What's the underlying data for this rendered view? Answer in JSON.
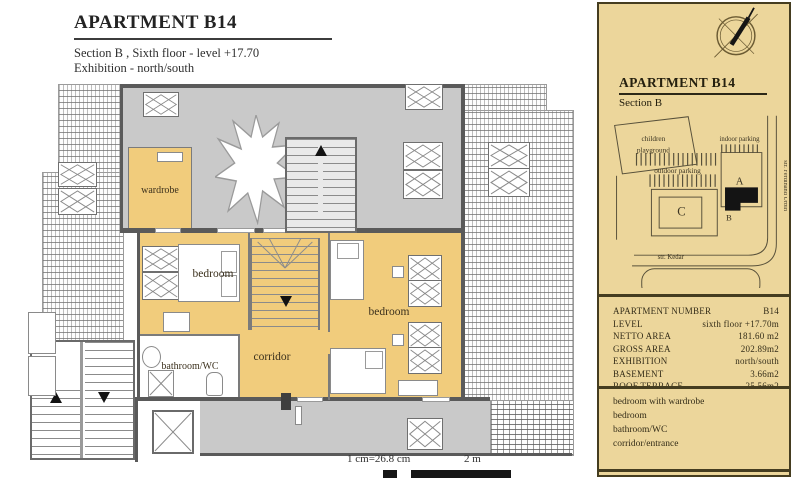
{
  "title_block": {
    "title": "APARTMENT B14",
    "line1": "Section B ,  Sixth floor - level +17.70",
    "line2": "Exhibition - north/south"
  },
  "plan": {
    "labels": {
      "wardrobe": "wardrobe",
      "bedroom_left": "bedroom",
      "bedroom_right": "bedroom",
      "corridor": "corridor",
      "bathroom": "bathroom/WC"
    },
    "scale": {
      "ratio": "1 cm=26.8 cm",
      "bar_label": "2 m"
    }
  },
  "panel": {
    "title": "APARTMENT B14",
    "subtitle": "Section B",
    "site": {
      "playground_line1": "children",
      "playground_line2": "playground",
      "indoor_parking": "indoor parking",
      "outdoor_parking": "outdoor parking",
      "building_a": "A",
      "building_b": "B",
      "building_c": "C",
      "street_right": "str. Ferdinand Urbih",
      "street_bottom": "str. Kedar"
    },
    "info_rows": [
      {
        "label": "APARTMENT NUMBER",
        "value": "B14"
      },
      {
        "label": "LEVEL",
        "value": "sixth floor +17.70m"
      },
      {
        "label": "NETTO AREA",
        "value": "181.60 m2"
      },
      {
        "label": "GROSS AREA",
        "value": "202.89m2"
      },
      {
        "label": "EXHIBITION",
        "value": "north/south"
      },
      {
        "label": "BASEMENT",
        "value": "3.66m2"
      },
      {
        "label": "ROOF TERRACE",
        "value": "25.56m2"
      }
    ],
    "rooms_list": [
      "bedroom with wardrobe",
      "bedroom",
      "bathroom/WC",
      "corridor/entrance"
    ]
  },
  "colors": {
    "panel_bg": "#ecd69b",
    "room_yellow": "#f1cc7c",
    "roof_gray": "#c9c9c9",
    "wall_dark": "#5a5a5a",
    "highlight_black": "#141414",
    "line_olive": "#57503a"
  }
}
